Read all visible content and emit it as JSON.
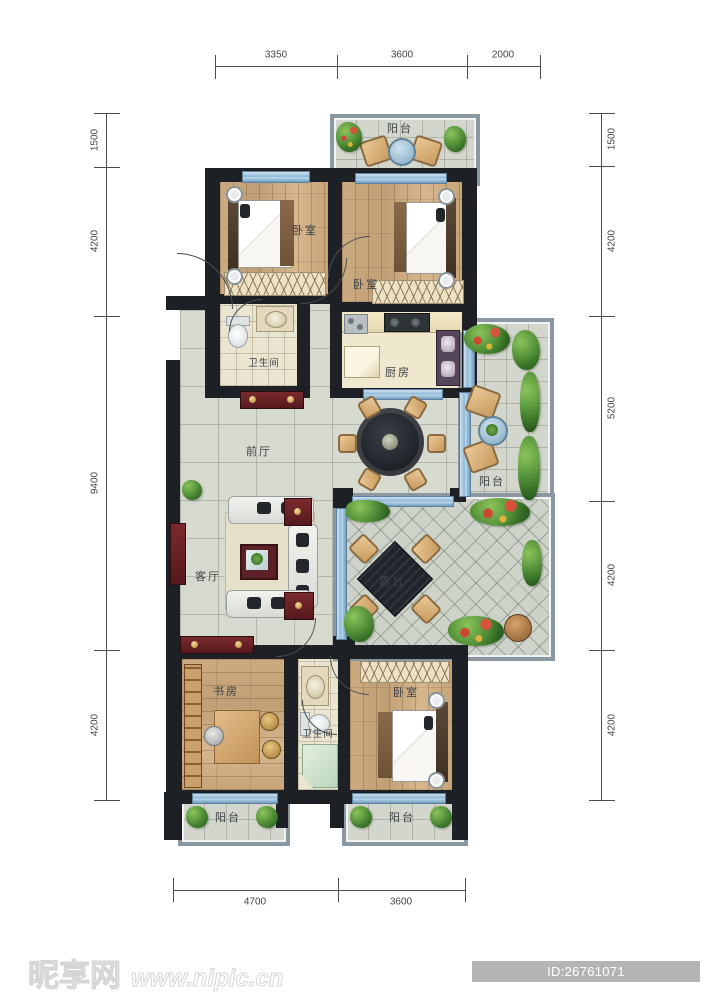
{
  "title": "residential floor plan",
  "dimensions": {
    "top": [
      "3350",
      "3600",
      "2000"
    ],
    "bottom": [
      "4700",
      "3600"
    ],
    "left": [
      "1500",
      "4200",
      "9400",
      "4200"
    ],
    "right": [
      "1500",
      "4200",
      "5200",
      "4200",
      "4200"
    ]
  },
  "rooms": {
    "balcony_top": "阳台",
    "bedroom_top_left": "卧室",
    "bedroom_top_right": "卧室",
    "bathroom_upper": "卫生间",
    "kitchen": "厨房",
    "front_hall": "前厅",
    "balcony_right": "阳台",
    "living_room": "客厅",
    "terrace": "露台",
    "study": "书房",
    "bathroom_lower": "卫生间",
    "bedroom_bottom_right": "卧室",
    "balcony_bottom_left": "阳台",
    "balcony_bottom_right": "阳台"
  },
  "watermark": {
    "site_name": "昵享网",
    "site_url": "www.nipic.cn",
    "id_text": "ID:26761071 NO:20200617165258955000"
  },
  "colors": {
    "wall": "#1d2125",
    "light_wall": "#8b98a1",
    "wood_floor": "#c9a87c",
    "hall_tile": "#d7dacf",
    "bath_tile": "#eae5d1",
    "window_glass": "#8fb8d6",
    "plant_green": "#55933a",
    "accent_red_furniture": "#6b2328",
    "id_badge_bg": "#b4b4b4"
  }
}
